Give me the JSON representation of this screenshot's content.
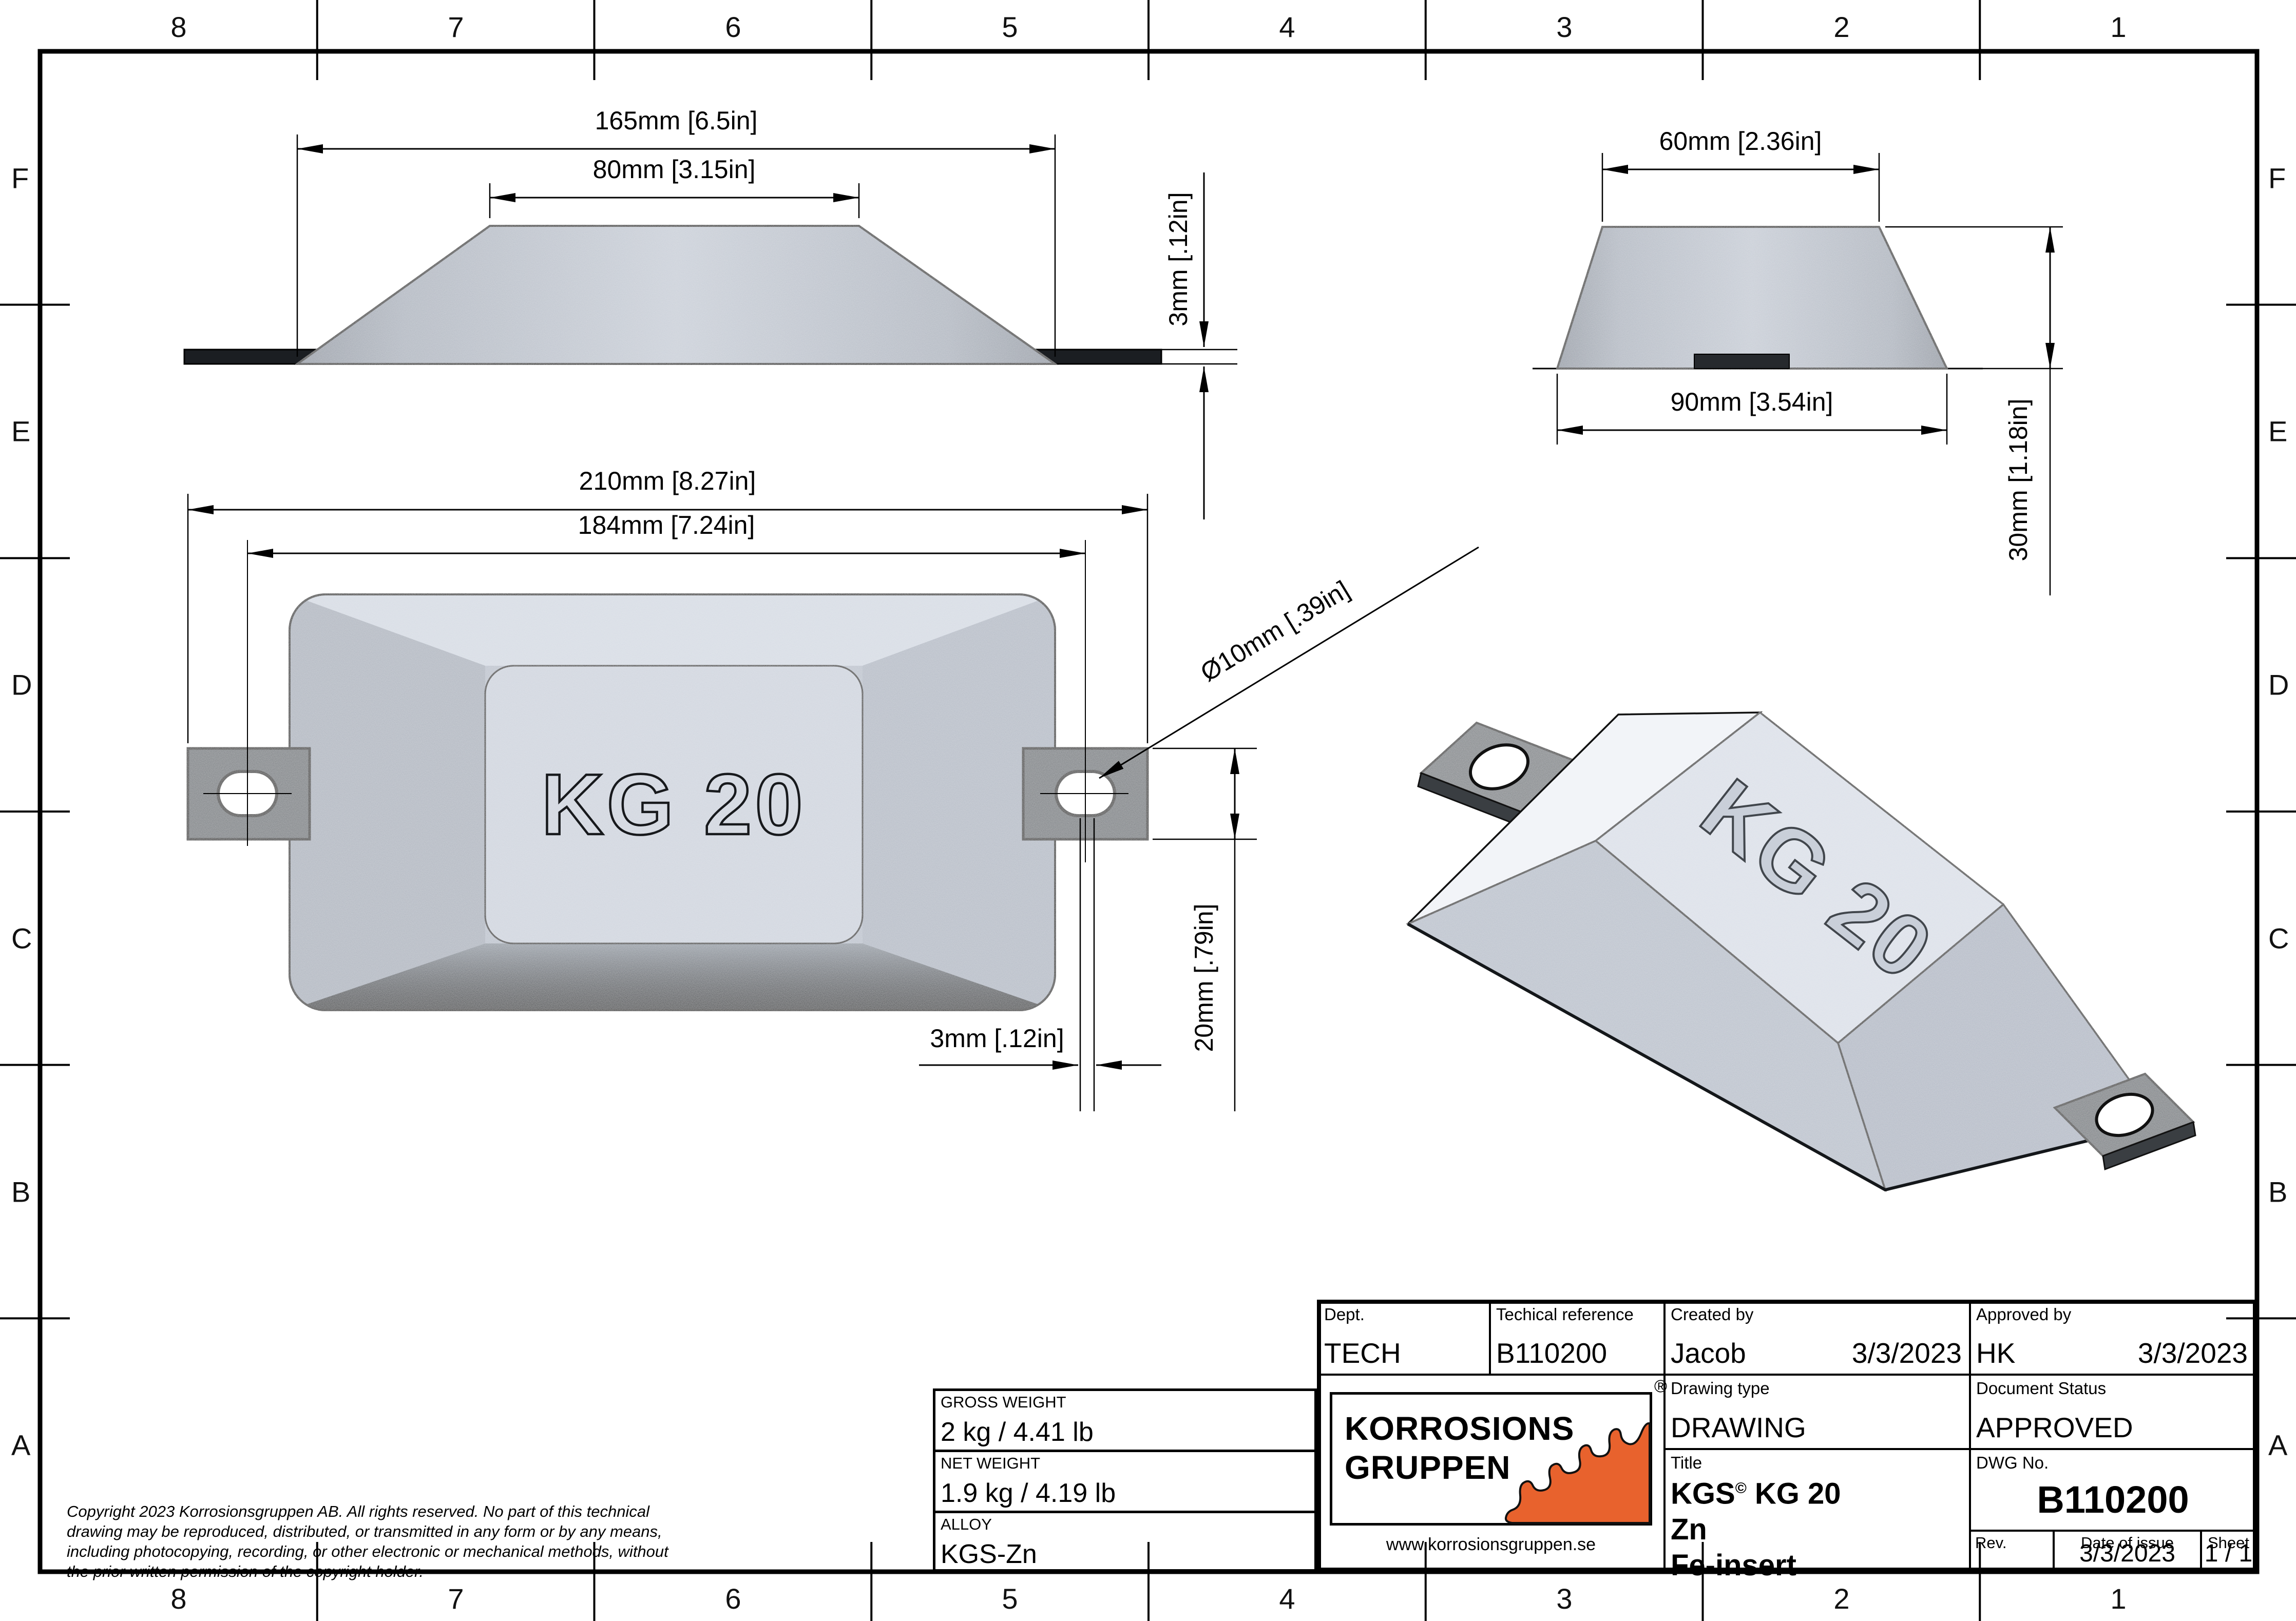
{
  "sheet": {
    "columns": [
      "8",
      "7",
      "6",
      "5",
      "4",
      "3",
      "2",
      "1"
    ],
    "rows": [
      "F",
      "E",
      "D",
      "C",
      "B",
      "A"
    ]
  },
  "views": {
    "side": {
      "dim_length": "165mm [6.5in]",
      "dim_top": "80mm [3.15in]",
      "dim_thickness": "3mm [.12in]"
    },
    "end": {
      "dim_top": "60mm [2.36in]",
      "dim_bottom": "90mm [3.54in]",
      "dim_height": "30mm [1.18in]"
    },
    "plan": {
      "dim_overall": "210mm [8.27in]",
      "dim_holes": "184mm [7.24in]",
      "dim_hole_dia": "Ø10mm [.39in]",
      "dim_tab": "20mm [.79in]",
      "dim_offset": "3mm [.12in]",
      "emboss": "KG 20"
    },
    "iso": {
      "emboss": "KG 20"
    }
  },
  "weights": {
    "gross_label": "GROSS WEIGHT",
    "gross_value": "2 kg / 4.41 lb",
    "net_label": "NET WEIGHT",
    "net_value": "1.9 kg / 4.19 lb",
    "alloy_label": "ALLOY",
    "alloy_value": "KGS-Zn"
  },
  "titleblock": {
    "dept_label": "Dept.",
    "dept_value": "TECH",
    "techref_label": "Techical reference",
    "techref_value": "B110200",
    "created_label": "Created by",
    "created_name": "Jacob",
    "created_date": "3/3/2023",
    "approved_label": "Approved by",
    "approved_name": "HK",
    "approved_date": "3/3/2023",
    "drawingtype_label": "Drawing type",
    "drawingtype_value": "DRAWING",
    "status_label": "Document Status",
    "status_value": "APPROVED",
    "title_label": "Title",
    "title_main": "KGS",
    "title_sup": "©",
    "title_rest": " KG 20",
    "title_line2": "Zn",
    "title_line3": "Fe-insert",
    "dwg_label": "DWG No.",
    "dwg_value": "B110200",
    "rev_label": "Rev.",
    "date_label": "Date of issue",
    "date_value": "3/3/2023",
    "sheet_label": "Sheet",
    "sheet_value": "1 / 1",
    "logo_line1": "KORROSIONS",
    "logo_line2": "GRUPPEN",
    "logo_url": "www.korrosionsgruppen.se",
    "logo_reg": "®",
    "logo_orange": "#E8622D"
  },
  "copyright": {
    "lines": [
      "Copyright 2023 Korrosionsgruppen AB. All rights reserved. No part of this technical",
      "drawing may be reproduced, distributed, or transmitted in any form or by any means,",
      "including photocopying, recording, or other electronic or mechanical methods, without",
      "the prior written permission of the copyright holder."
    ]
  }
}
